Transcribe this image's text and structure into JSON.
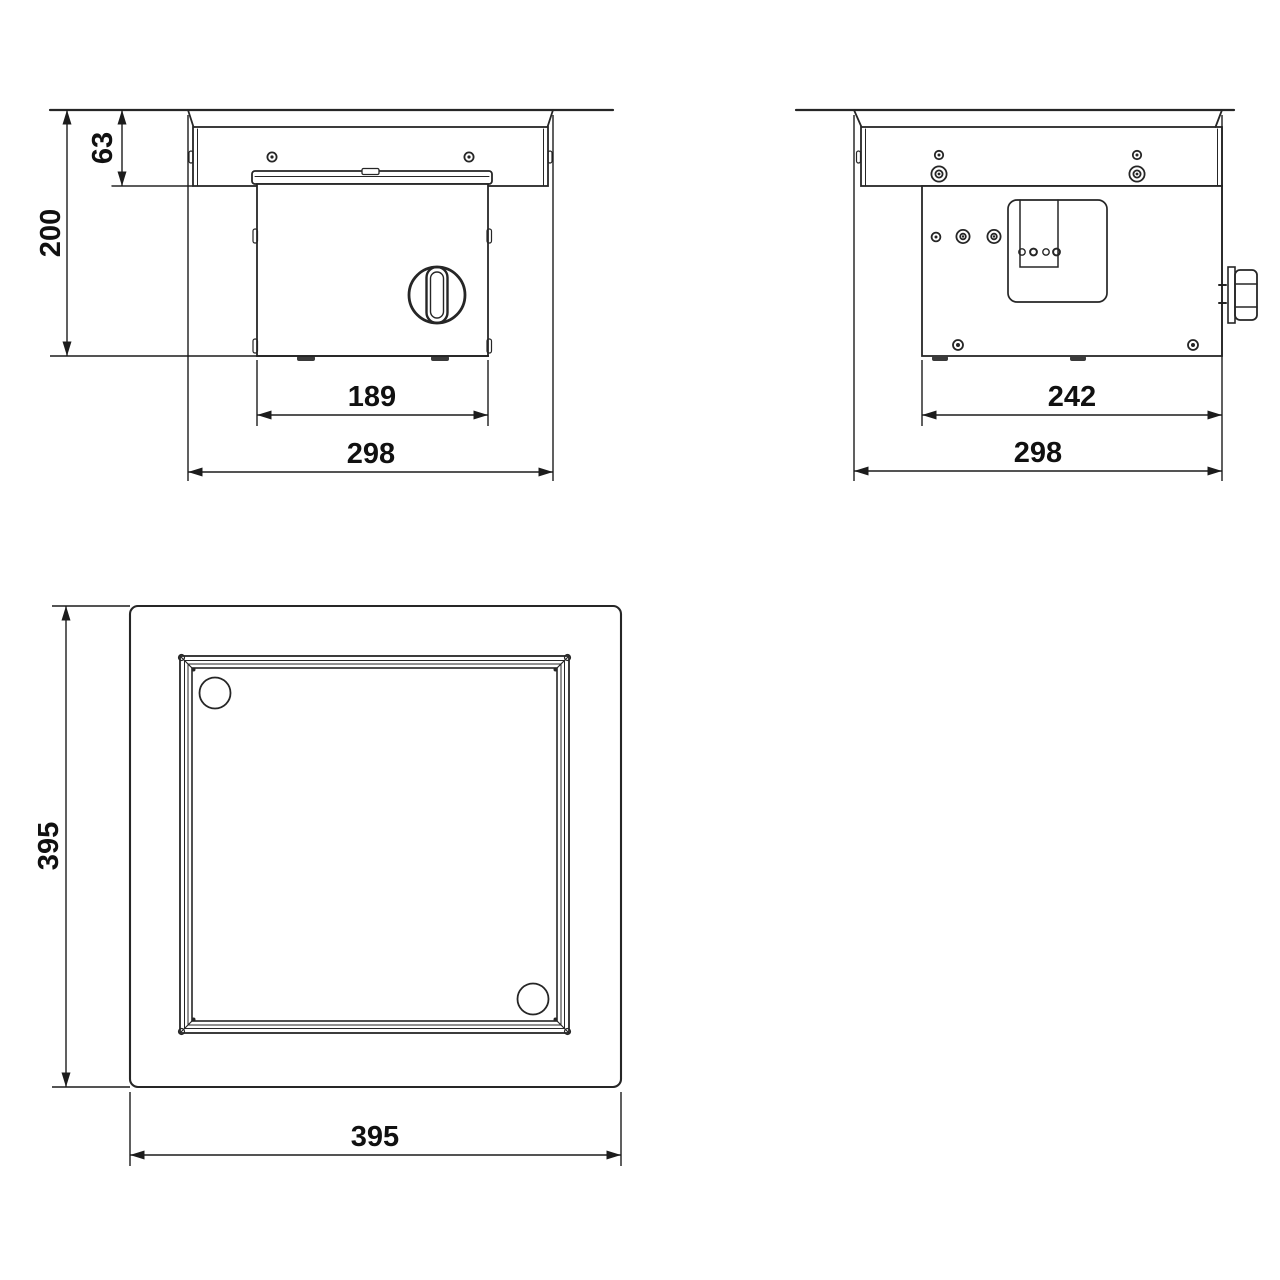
{
  "drawing": {
    "type": "technical-dimension-drawing",
    "units": "mm",
    "views": {
      "front_section": {
        "label": "front section view",
        "dims": {
          "recess_depth": "63",
          "overall_depth": "200",
          "body_width": "189",
          "cutout_width": "298"
        }
      },
      "side_section": {
        "label": "side section view",
        "dims": {
          "body_width": "242",
          "cutout_width": "298"
        }
      },
      "plan": {
        "label": "top plan view",
        "dims": {
          "overall_height": "395",
          "overall_width": "395"
        }
      }
    }
  }
}
